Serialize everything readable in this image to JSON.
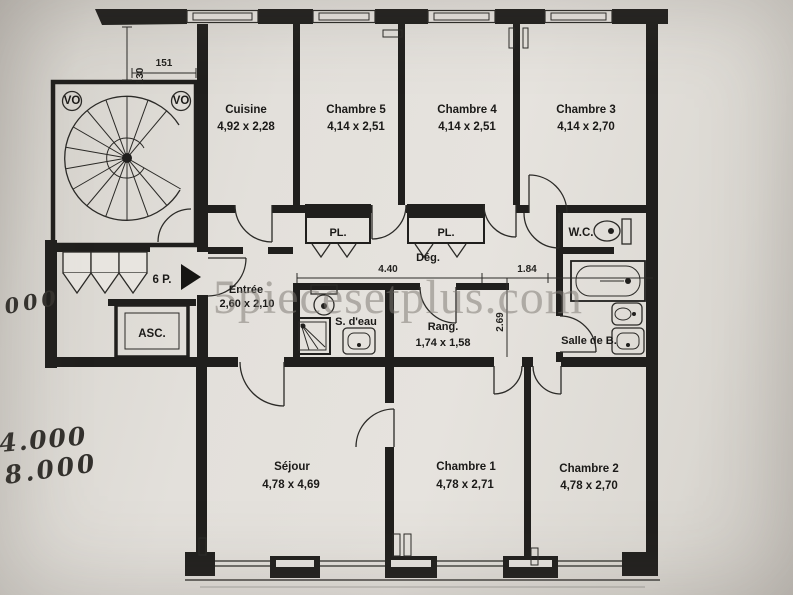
{
  "watermark": {
    "text": "5piecesetplus.com"
  },
  "apartment": {
    "type_label": "6 P."
  },
  "rooms": {
    "cuisine": {
      "name": "Cuisine",
      "dims": "4,92 x 2,28"
    },
    "chambre5": {
      "name": "Chambre 5",
      "dims": "4,14 x 2,51"
    },
    "chambre4": {
      "name": "Chambre 4",
      "dims": "4,14 x 2,51"
    },
    "chambre3": {
      "name": "Chambre 3",
      "dims": "4,14 x 2,70"
    },
    "sejour": {
      "name": "Séjour",
      "dims": "4,78 x 4,69"
    },
    "chambre1": {
      "name": "Chambre 1",
      "dims": "4,78 x 2,71"
    },
    "chambre2": {
      "name": "Chambre 2",
      "dims": "4,78 x 2,70"
    },
    "entree": {
      "name": "Entrée",
      "dims": "2,60 x 2,10"
    },
    "rangement": {
      "name": "Rang.",
      "dims": "1,74 x 1,58"
    },
    "salle_deau": {
      "name": "S. d'eau"
    },
    "salle_de_bain": {
      "name": "Salle de B."
    },
    "wc": {
      "name": "W.C."
    },
    "degagement": {
      "name": "Dég."
    },
    "placard": {
      "name": "PL."
    },
    "ascenseur": {
      "name": "ASC."
    }
  },
  "dimensions": {
    "light_well_depth": "130",
    "light_well_width": "151",
    "hall_length": "4.40",
    "passage_width": "1.84",
    "passage_depth": "2.69"
  },
  "stair": {
    "vo_label": "VO"
  },
  "handwritten": {
    "note1": "000",
    "note2": "4.000",
    "note3": "8.000"
  },
  "colors": {
    "ink": "#201f1d",
    "paper": "#e6e3de",
    "watermark": "#7e7973"
  }
}
